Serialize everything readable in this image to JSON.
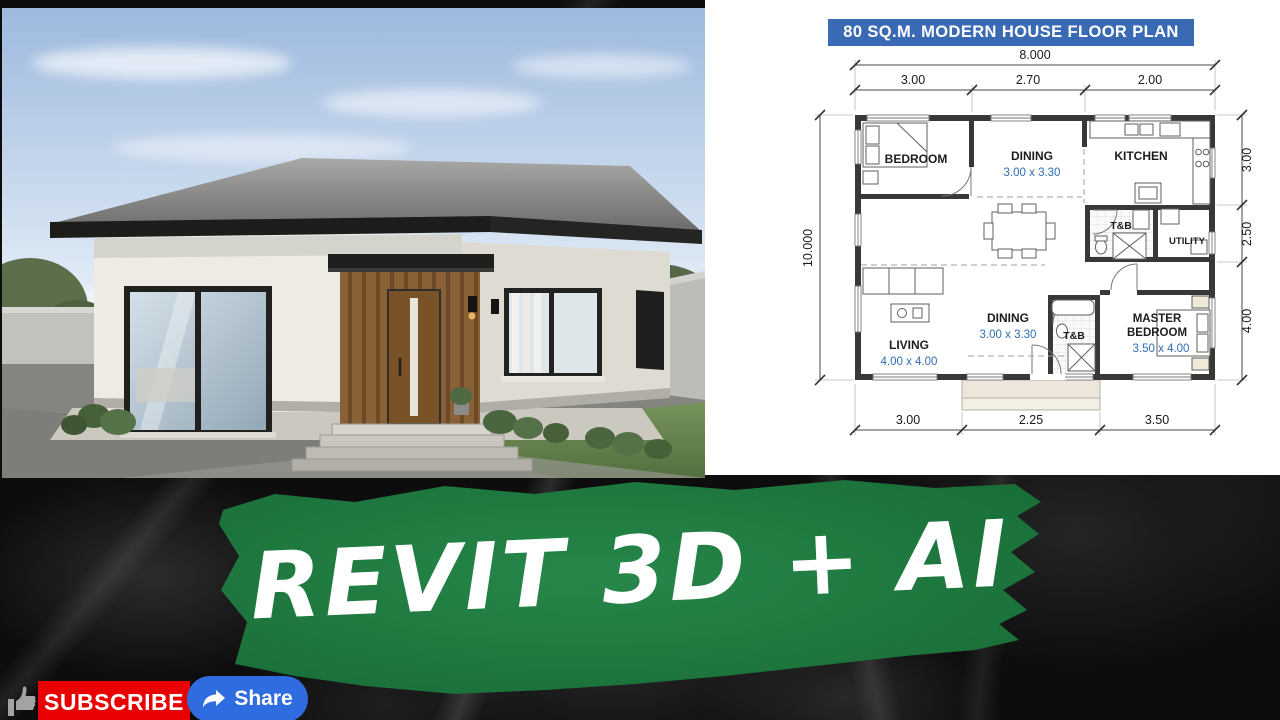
{
  "floor_plan": {
    "title": "80 SQ.M. MODERN HOUSE FLOOR PLAN",
    "banner_color": "#3a6ab4",
    "size_text_color": "#2e6db4",
    "dimensions": {
      "overall_top": "8.000",
      "overall_left": "10.000",
      "top": [
        "3.00",
        "2.70",
        "2.00"
      ],
      "right": [
        "3.00",
        "2.50",
        "4.00"
      ],
      "bottom": [
        "3.00",
        "2.25",
        "3.50"
      ]
    },
    "rooms": {
      "bedroom": {
        "label": "BEDROOM"
      },
      "dining_top": {
        "label": "DINING",
        "size": "3.00 x 3.30"
      },
      "kitchen": {
        "label": "KITCHEN"
      },
      "tb_upper": {
        "label": "T&B"
      },
      "utility": {
        "label": "UTILITY"
      },
      "living": {
        "label": "LIVING",
        "size": "4.00 x 4.00"
      },
      "dining_lower": {
        "label": "DINING",
        "size": "3.00 x 3.30"
      },
      "tb_lower": {
        "label": "T&B"
      },
      "master": {
        "label_line1": "MASTER",
        "label_line2": "BEDROOM",
        "size": "3.50 x 4.00"
      }
    }
  },
  "headline": {
    "text": "REVIT 3D + AI",
    "brush_color": "#1d7b3e"
  },
  "actions": {
    "subscribe_label": "SUBSCRIBE",
    "subscribe_color": "#e90000",
    "share_label": "Share",
    "share_color": "#2e6ce0"
  }
}
